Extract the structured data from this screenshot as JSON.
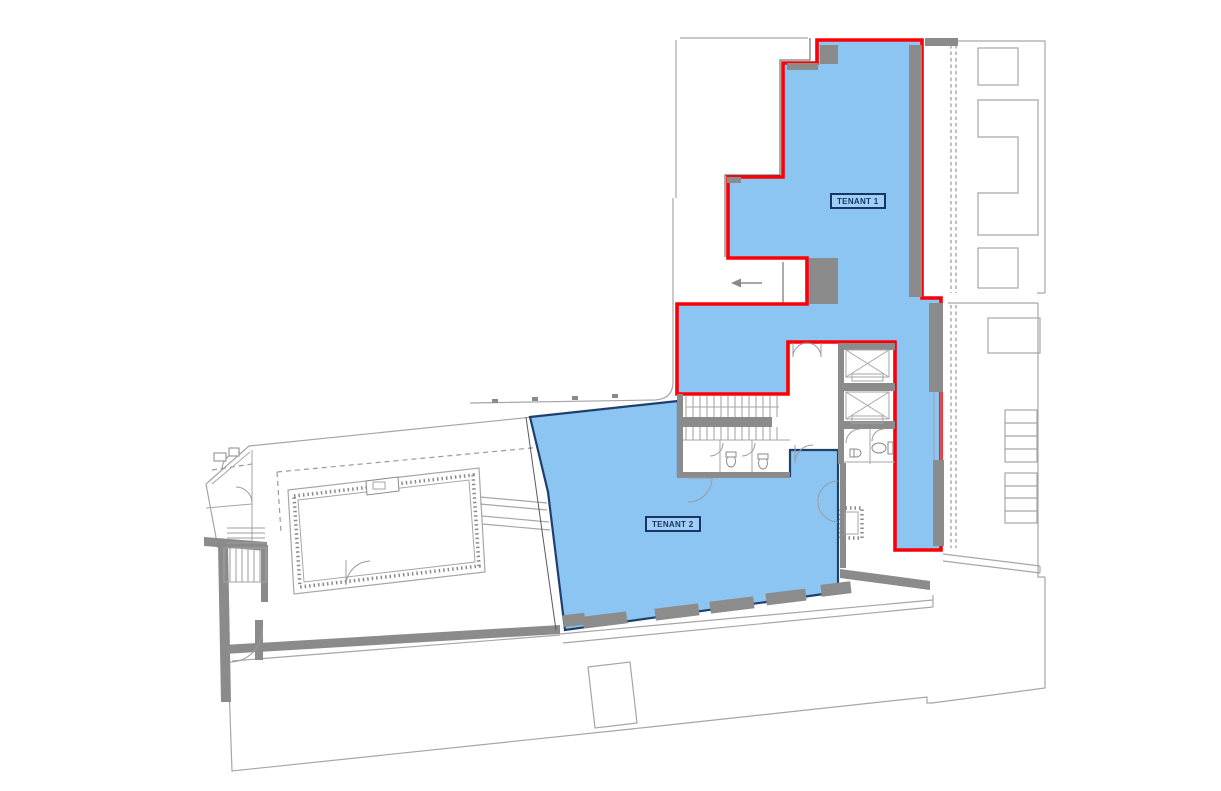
{
  "plan": {
    "tenant1": {
      "label": "TENANT 1"
    },
    "tenant2": {
      "label": "TENANT 2"
    },
    "entry_arrow_icon": "left-arrow"
  },
  "colors": {
    "page_bg": "#ffffff",
    "tenant_fill": "#8cc4f2",
    "tenant1_boundary": "#fb0006",
    "tenant2_boundary": "#20406c",
    "label_text": "#17356b",
    "label_border": "#17356b",
    "wall": "#8b8b8b",
    "outline": "#a6a6a6",
    "outline_dark": "#5a5a5a"
  }
}
